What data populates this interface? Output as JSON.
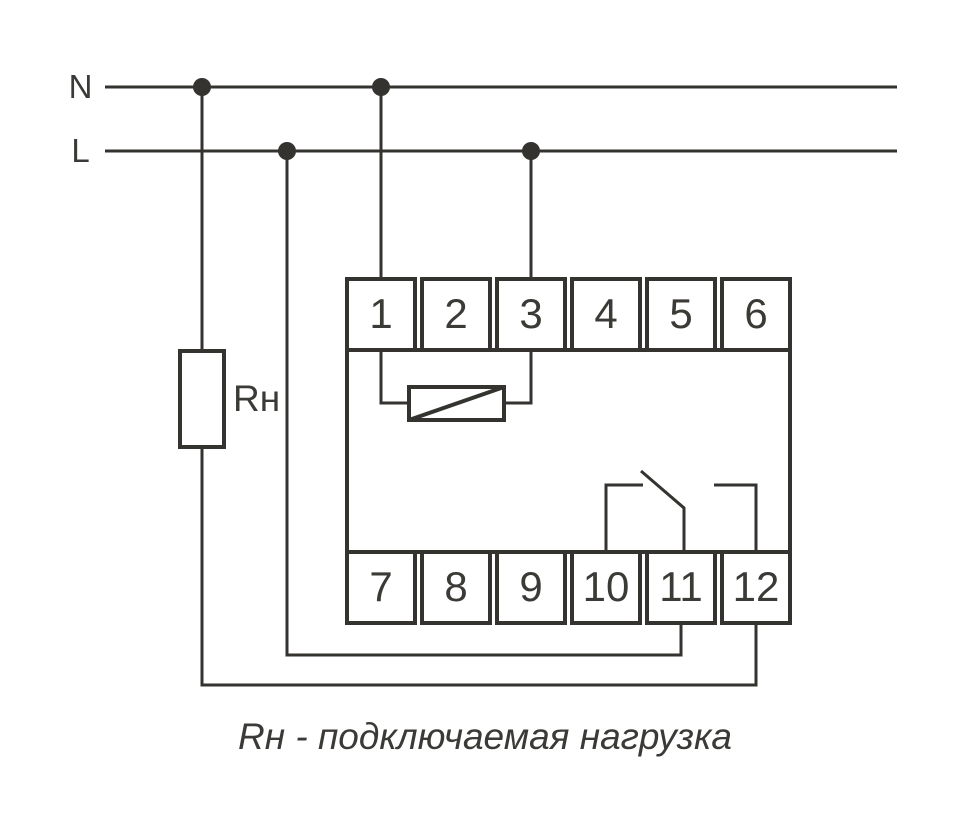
{
  "labels": {
    "neutral": "N",
    "line": "L",
    "load": "Rн"
  },
  "terminals": {
    "top": [
      "1",
      "2",
      "3",
      "4",
      "5",
      "6"
    ],
    "bottom": [
      "7",
      "8",
      "9",
      "10",
      "11",
      "12"
    ]
  },
  "caption": "Rн - подключаемая нагрузка",
  "colors": {
    "ink": "#34332f",
    "background": "#ffffff"
  }
}
